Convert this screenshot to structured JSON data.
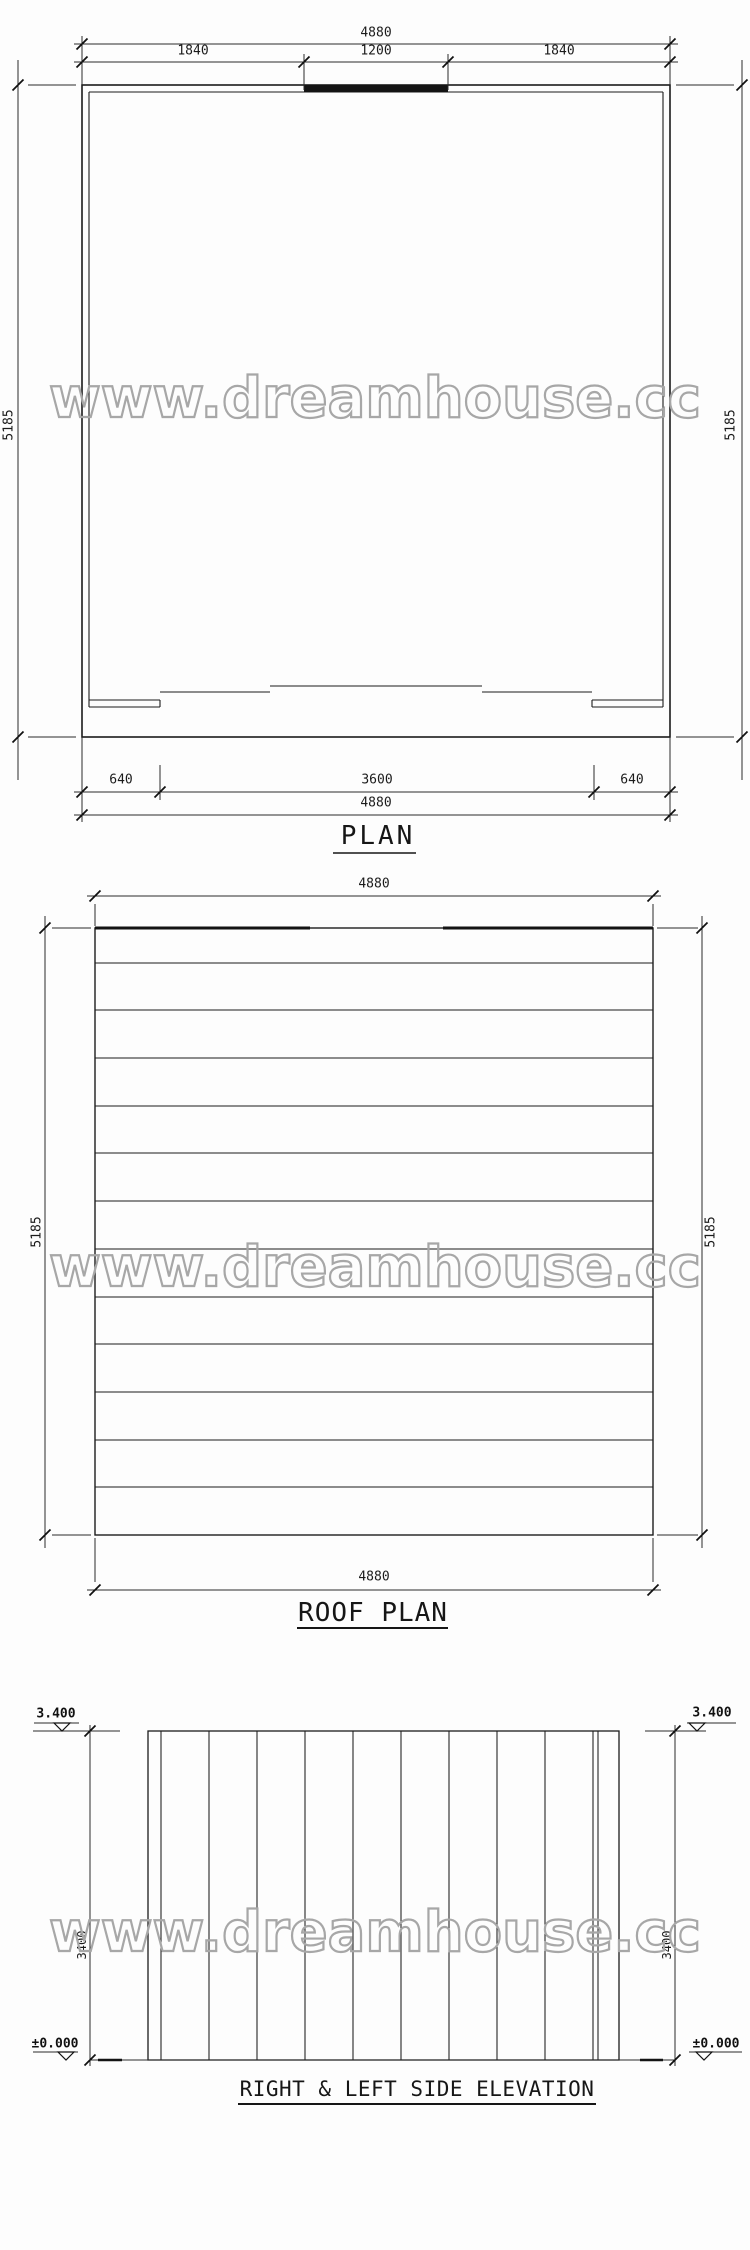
{
  "watermark": {
    "text": "www.dreamhouse.cc",
    "color": "#a7a7a7"
  },
  "plan": {
    "title": "PLAN",
    "dims": {
      "top_overall": "4880",
      "top_segments": [
        "1840",
        "1200",
        "1840"
      ],
      "side_left": "5185",
      "side_right": "5185",
      "bottom_segments": [
        "640",
        "3600",
        "640"
      ],
      "bottom_overall": "4880"
    }
  },
  "roof": {
    "title": "ROOF PLAN",
    "dims": {
      "top_overall": "4880",
      "bottom_overall": "4880",
      "side_left": "5185",
      "side_right": "5185"
    }
  },
  "elevation": {
    "title": "RIGHT & LEFT SIDE ELEVATION",
    "levels": {
      "top_left": "3.400",
      "top_right": "3.400",
      "ground_left": "±0.000",
      "ground_right": "±0.000"
    },
    "dims": {
      "side_left": "3400",
      "side_right": "3400"
    }
  }
}
